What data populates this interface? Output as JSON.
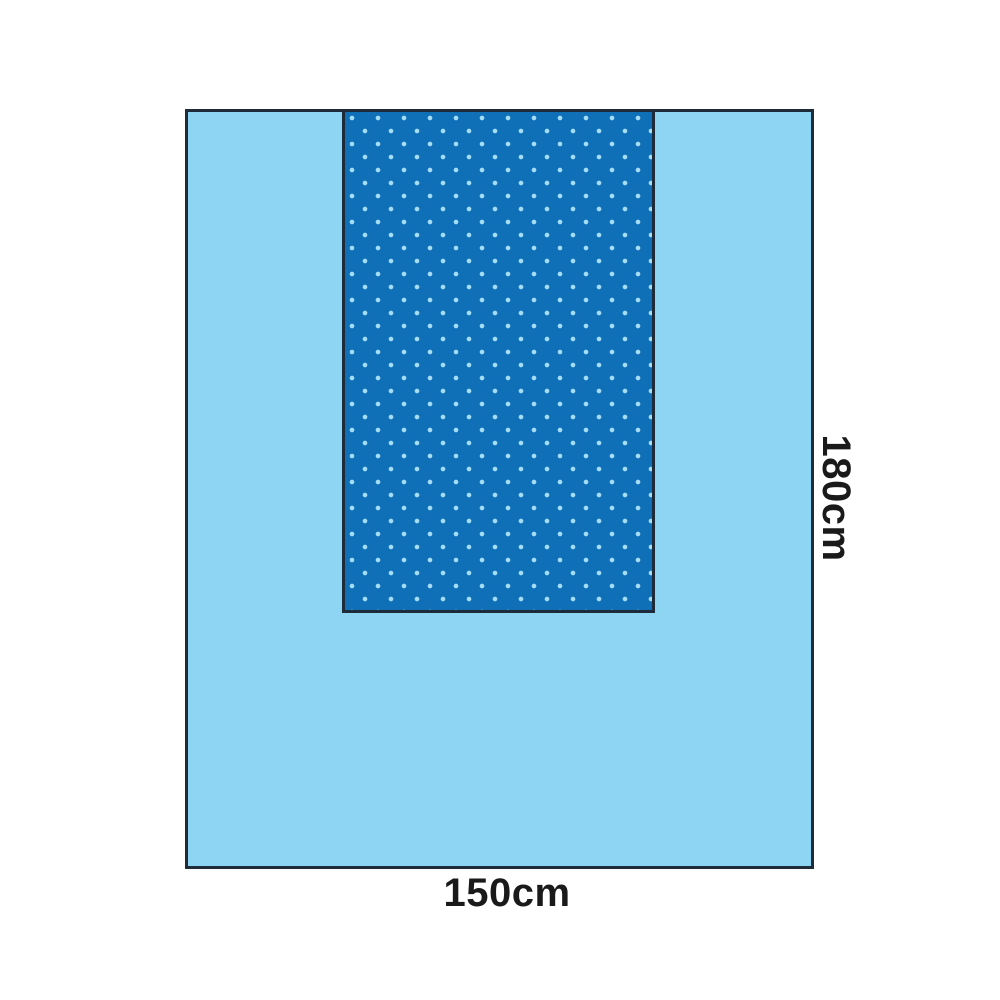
{
  "diagram": {
    "title": "surgical-drape-dimension-diagram",
    "width_label": "150cm",
    "height_label": "180cm"
  },
  "colors": {
    "background": "#ffffff",
    "drape": "#8ed5f3",
    "reinforcement": "#0f70b7",
    "dots": "#a5ddf5",
    "outline": "#1e2c3a",
    "label_text": "#1a1a1a"
  }
}
